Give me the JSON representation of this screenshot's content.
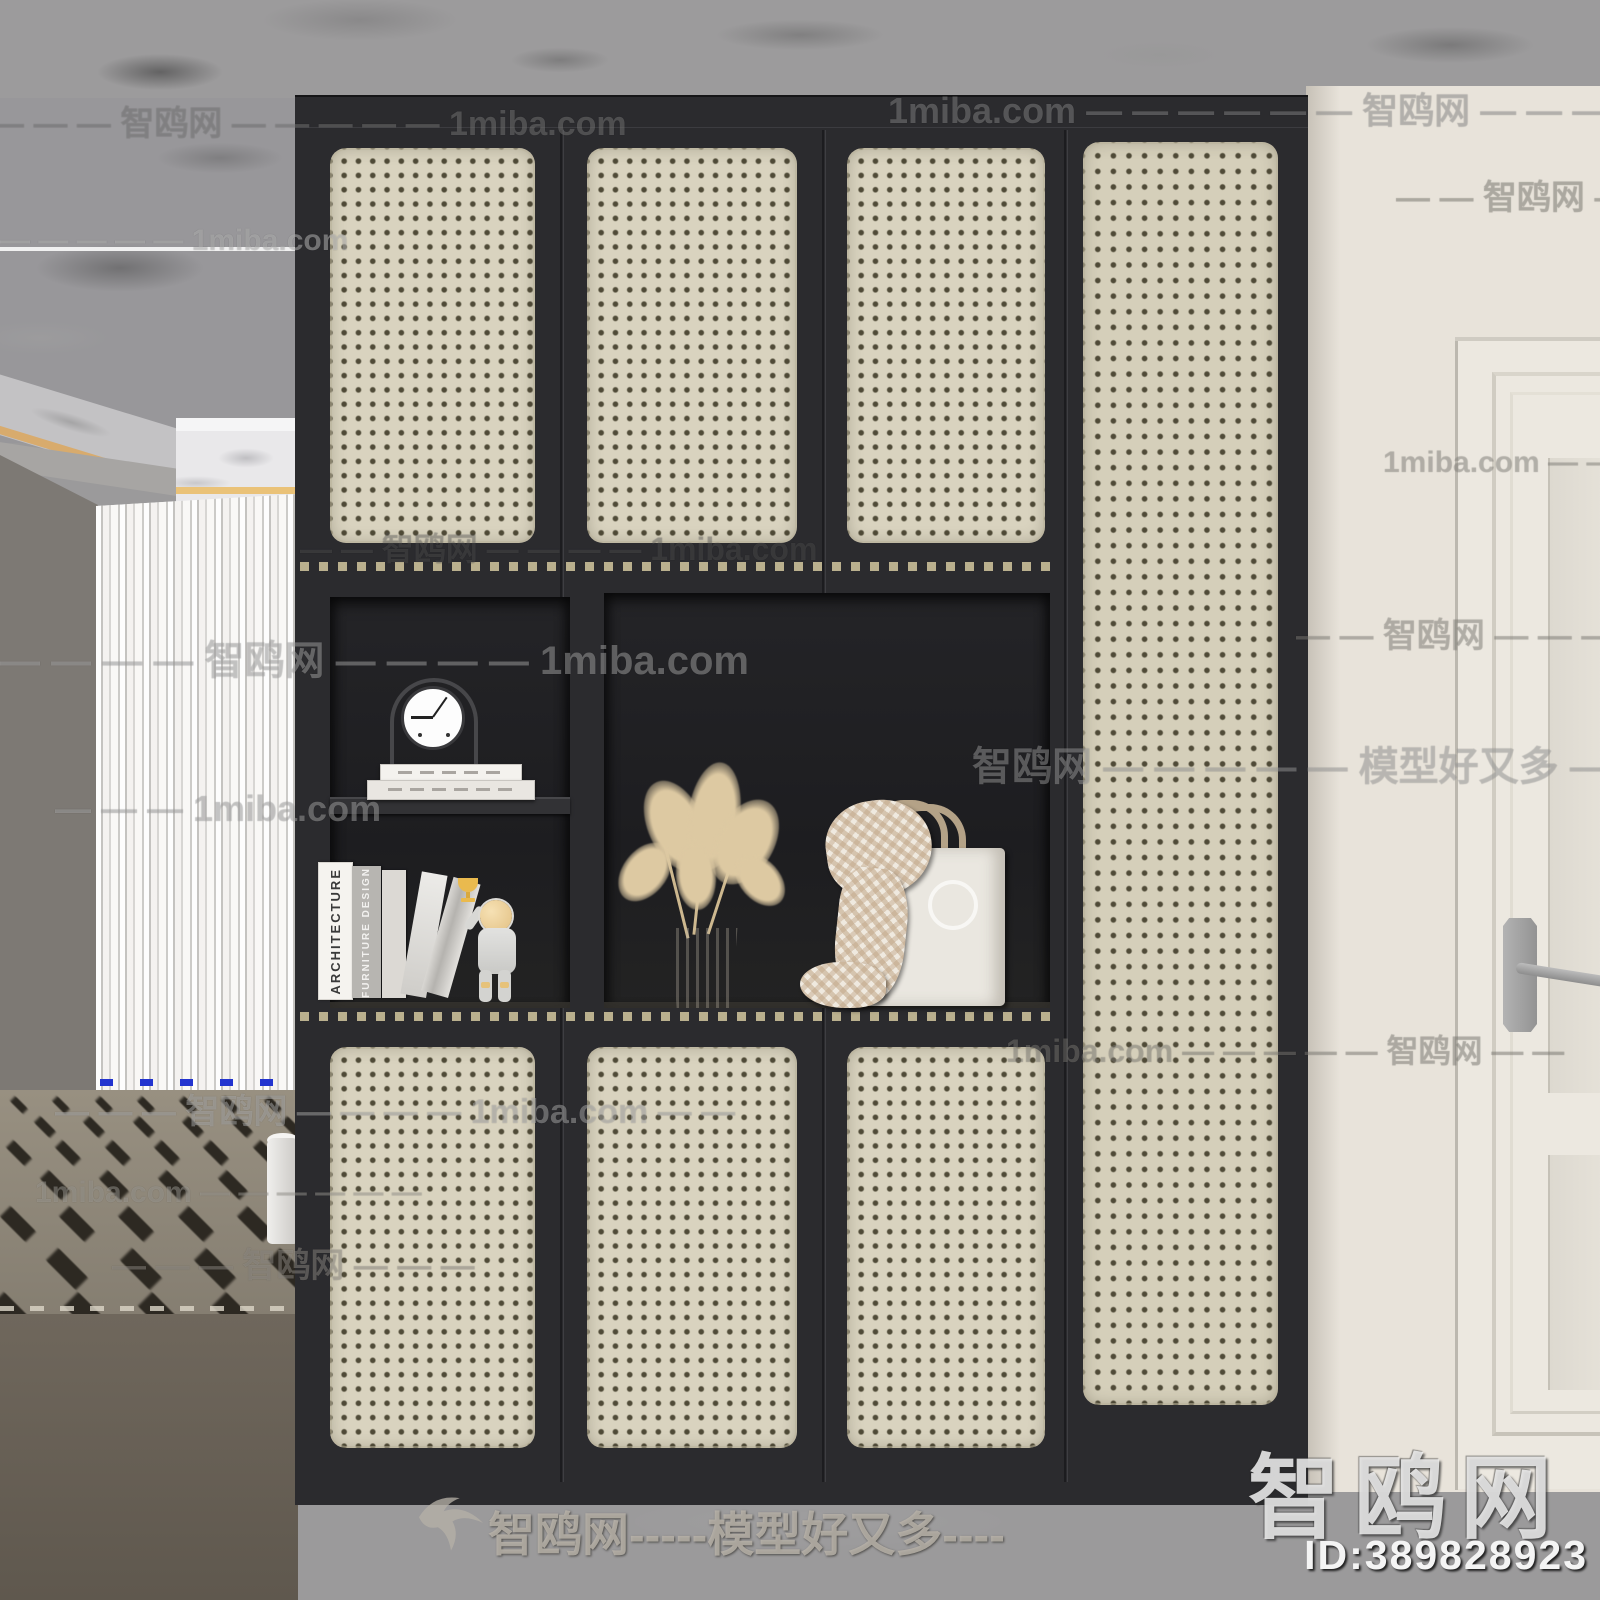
{
  "watermarks": {
    "site_name": "智鸥网",
    "site_url": "1miba.com",
    "slogan": "模型好又多",
    "footer_text": "智鸥网-----模型好又多----",
    "corner_logo_text": "智鸥网",
    "model_id": "ID:389828923",
    "tiled": [
      {
        "text": "— — — 智鸥网 — — — — — 1miba.com",
        "x": -10,
        "y": 96,
        "fs": 34,
        "color": "rgba(150,150,150,0.40)"
      },
      {
        "text": "1miba.com — — — — — — 智鸥网 — — — — — 1miba",
        "x": 888,
        "y": 82,
        "fs": 36,
        "color": "rgba(185,185,185,0.35)"
      },
      {
        "text": "— — — — — 1miba.com",
        "x": 0,
        "y": 224,
        "fs": 30,
        "color": "rgba(215,215,215,0.45)"
      },
      {
        "text": "— — 智鸥网 — — — —",
        "x": 1396,
        "y": 170,
        "fs": 34,
        "color": "rgba(168,164,156,0.40)"
      },
      {
        "text": "1miba.com — —",
        "x": 1383,
        "y": 446,
        "fs": 30,
        "color": "rgba(180,176,168,0.38)"
      },
      {
        "text": "— — 智鸥网 — — — — 1miba.com",
        "x": 300,
        "y": 524,
        "fs": 32,
        "color": "rgba(140,140,140,0.22)"
      },
      {
        "text": "— — — — 智鸥网 — — — — 1miba.com",
        "x": 0,
        "y": 628,
        "fs": 40,
        "color": "rgba(205,205,205,0.40)"
      },
      {
        "text": "— — 智鸥网 — — — —",
        "x": 1296,
        "y": 608,
        "fs": 34,
        "color": "rgba(176,172,164,0.35)"
      },
      {
        "text": "智鸥网 — — — — — 模型好又多 — —",
        "x": 972,
        "y": 734,
        "fs": 40,
        "color": "rgba(200,200,200,0.38)"
      },
      {
        "text": "— — — 1miba.com",
        "x": 55,
        "y": 788,
        "fs": 36,
        "color": "rgba(205,205,205,0.40)"
      },
      {
        "text": "1miba.com — — — — — 智鸥网 — —",
        "x": 1006,
        "y": 1026,
        "fs": 32,
        "color": "rgba(170,166,158,0.35)"
      },
      {
        "text": "— — — 智鸥网 — — — — 1miba.com — —",
        "x": 55,
        "y": 1084,
        "fs": 34,
        "color": "rgba(205,205,205,0.42)"
      },
      {
        "text": "1miba.com — — — — — —",
        "x": 35,
        "y": 1176,
        "fs": 30,
        "color": "rgba(200,196,188,0.38)"
      },
      {
        "text": "— — — 智鸥网 — — —",
        "x": 112,
        "y": 1238,
        "fs": 34,
        "color": "rgba(184,180,172,0.38)"
      }
    ]
  },
  "cabinet": {
    "shelf_books": {
      "spine1": "ARCHITECTURE",
      "spine2": "FURNITURE DESIGN"
    }
  },
  "colors": {
    "cabinet_frame": "#2b2b2e",
    "cane_panel": "#d9d3bf",
    "cane_dot": "#504b38",
    "trim_dash": "#d3c79f",
    "right_wall": "#e8e3da",
    "door": "#ece8e0",
    "floor": "#6b6356",
    "accent_gold": "#d8ab6d"
  }
}
